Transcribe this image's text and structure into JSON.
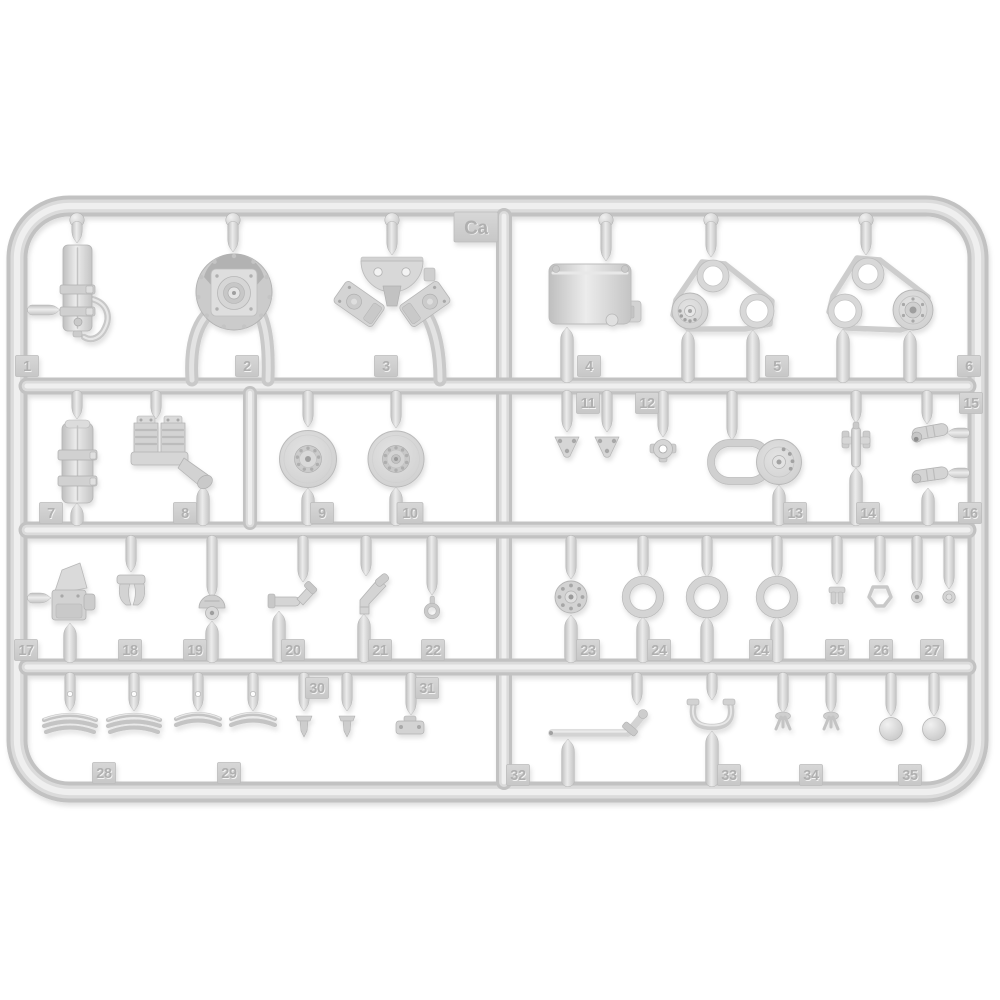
{
  "description": "Photo of a light gray injection-molded plastic model kit sprue, frame code Ca, with numbered part tags",
  "sprue": {
    "code": "Ca",
    "part_numbers": [
      "1",
      "2",
      "3",
      "4",
      "5",
      "6",
      "7",
      "8",
      "9",
      "10",
      "11",
      "12",
      "13",
      "14",
      "15",
      "16",
      "17",
      "18",
      "19",
      "20",
      "21",
      "22",
      "23",
      "24",
      "25",
      "26",
      "27",
      "28",
      "29",
      "30",
      "31",
      "32",
      "33",
      "34",
      "35"
    ],
    "tags": [
      {
        "label": "1"
      },
      {
        "label": "2"
      },
      {
        "label": "3"
      },
      {
        "label": "4"
      },
      {
        "label": "5"
      },
      {
        "label": "6"
      },
      {
        "label": "7"
      },
      {
        "label": "8"
      },
      {
        "label": "9"
      },
      {
        "label": "10"
      },
      {
        "label": "11"
      },
      {
        "label": "12"
      },
      {
        "label": "13"
      },
      {
        "label": "14"
      },
      {
        "label": "15"
      },
      {
        "label": "16"
      },
      {
        "label": "17"
      },
      {
        "label": "18"
      },
      {
        "label": "19"
      },
      {
        "label": "20"
      },
      {
        "label": "21"
      },
      {
        "label": "22"
      },
      {
        "label": "23"
      },
      {
        "label": "24"
      },
      {
        "label": "24"
      },
      {
        "label": "25"
      },
      {
        "label": "26"
      },
      {
        "label": "27"
      },
      {
        "label": "28"
      },
      {
        "label": "29"
      },
      {
        "label": "30"
      },
      {
        "label": "31"
      },
      {
        "label": "32"
      },
      {
        "label": "33"
      },
      {
        "label": "34"
      },
      {
        "label": "35"
      },
      {
        "label": "Ca"
      }
    ],
    "colors": {
      "background": "#ffffff",
      "plastic": "#d5d5d5",
      "plastic_highlight": "#efefef",
      "plastic_shadow": "#c0c0c0",
      "tag_plate": "#cfcfcf",
      "tag_number": "#b0b0b0"
    }
  }
}
